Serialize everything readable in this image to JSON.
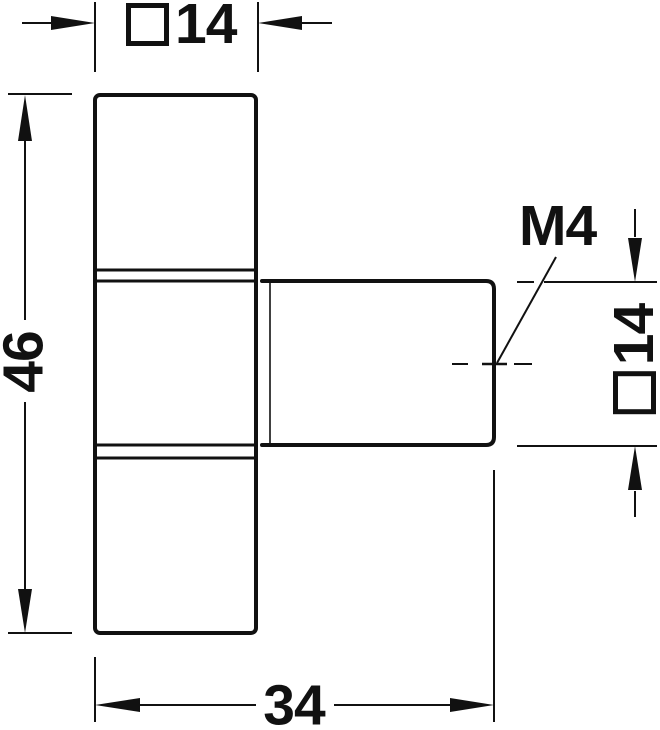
{
  "drawing": {
    "type": "technical-dimension-drawing",
    "part": "T-shaped knob, side elevation",
    "colors": {
      "line": "#111111",
      "background": "#ffffff"
    },
    "dims": {
      "top": {
        "symbol": "square-profile",
        "value": "14"
      },
      "left": {
        "value": "46"
      },
      "right": {
        "symbol": "square-profile",
        "value": "14"
      },
      "bottom": {
        "value": "34"
      },
      "thread": {
        "label": "M4"
      }
    }
  }
}
